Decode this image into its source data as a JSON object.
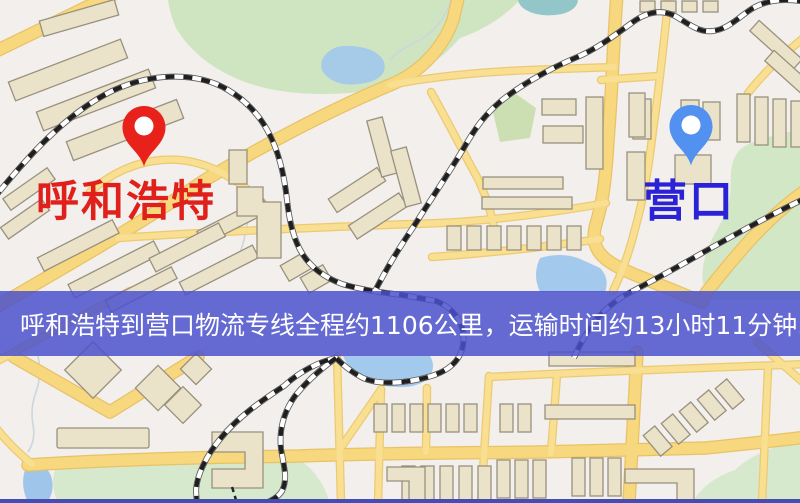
{
  "banner": {
    "text": "呼和浩特到营口物流专线全程约1106公里，运输时间约13小时11分钟.",
    "bg_color": "#4a50cd",
    "text_color": "#ffffff"
  },
  "origin": {
    "label": "呼和浩特",
    "label_color": "#e0201a",
    "pin_color": "#e8211a"
  },
  "destination": {
    "label": "营口",
    "label_color": "#2a22d6",
    "pin_color": "#5291f0"
  },
  "map_palette": {
    "base": "#f2efec",
    "road_fill": "#f7d87f",
    "road_casing": "#e8c266",
    "building": "#eae2c9",
    "building_stroke": "#99917e",
    "park": "#cfe5c2",
    "water": "#a3c9ec",
    "railway_dark": "#1f1f1f",
    "bottom_strip": "#474cb3"
  }
}
